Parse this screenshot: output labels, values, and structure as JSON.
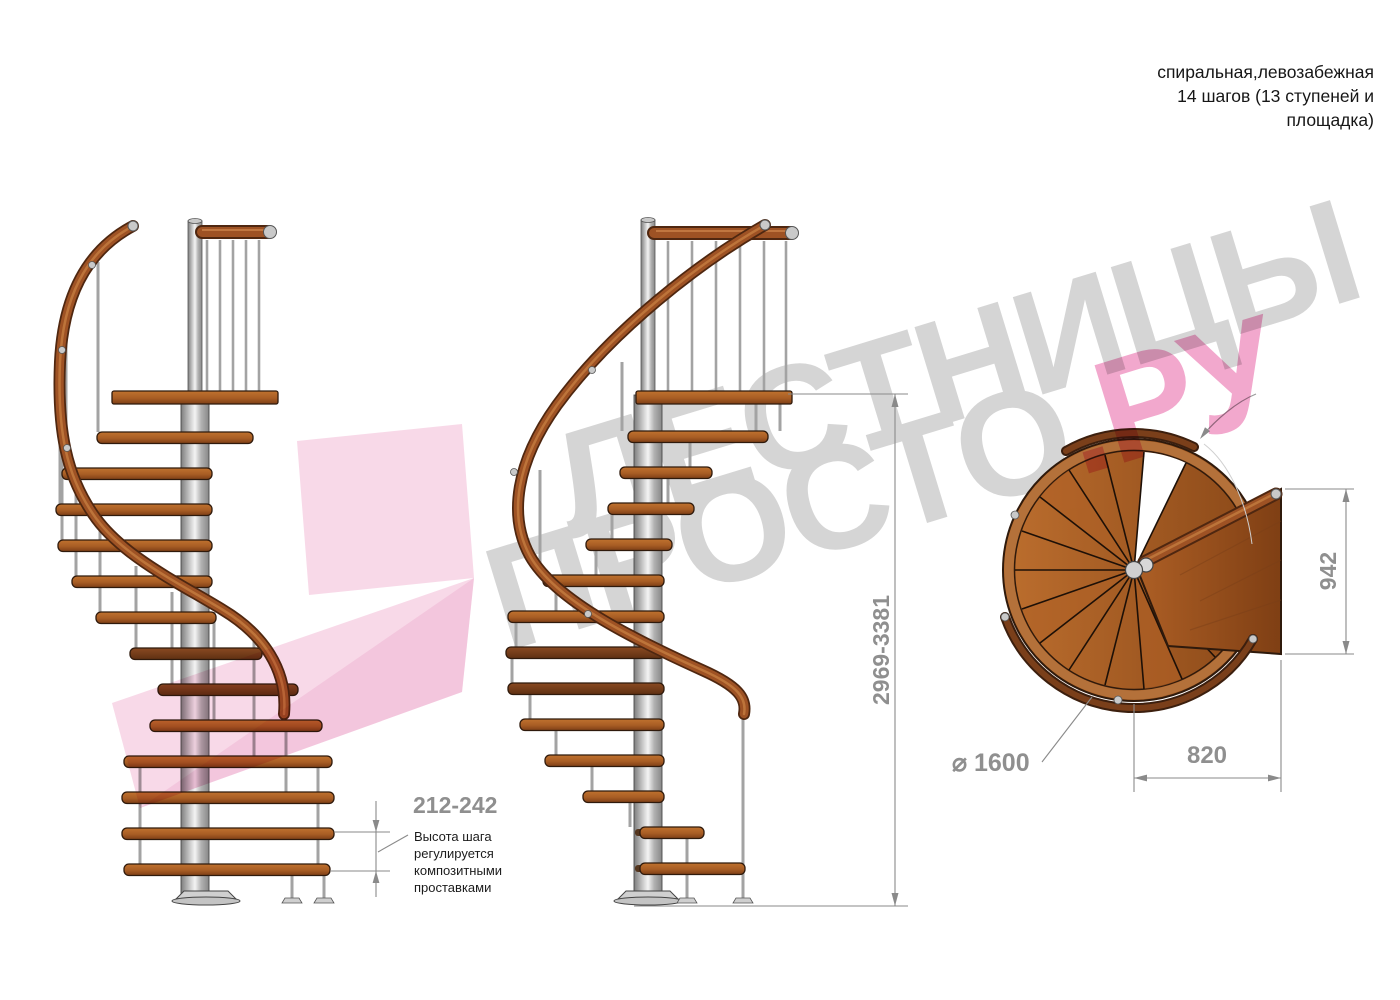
{
  "title": {
    "text": "спиральная,левозабежная\n14 шагов (13 ступеней и\nплощадка)"
  },
  "dimensions": {
    "total_height": "2969-3381",
    "platform_depth": "942",
    "platform_length": "820",
    "diameter": "⌀ 1600",
    "step_height": "212-242",
    "step_height_note": "Высота шага\nрегулируется\nкомпозитными\nпроставками"
  },
  "watermark": {
    "line1": "ЛЕСТНИЦЫ",
    "line2_gray": "ПРОСТО",
    "line2_pink": ".РУ"
  },
  "colors": {
    "wood": "#a9612b",
    "wood_dark": "#6e3a1c",
    "handrail": "#9e5224",
    "metal": "#c9c9c9",
    "dimension_gray": "#8a8a8a",
    "watermark_gray": "#d5d5d5",
    "watermark_pink": "#f2a8cd"
  }
}
